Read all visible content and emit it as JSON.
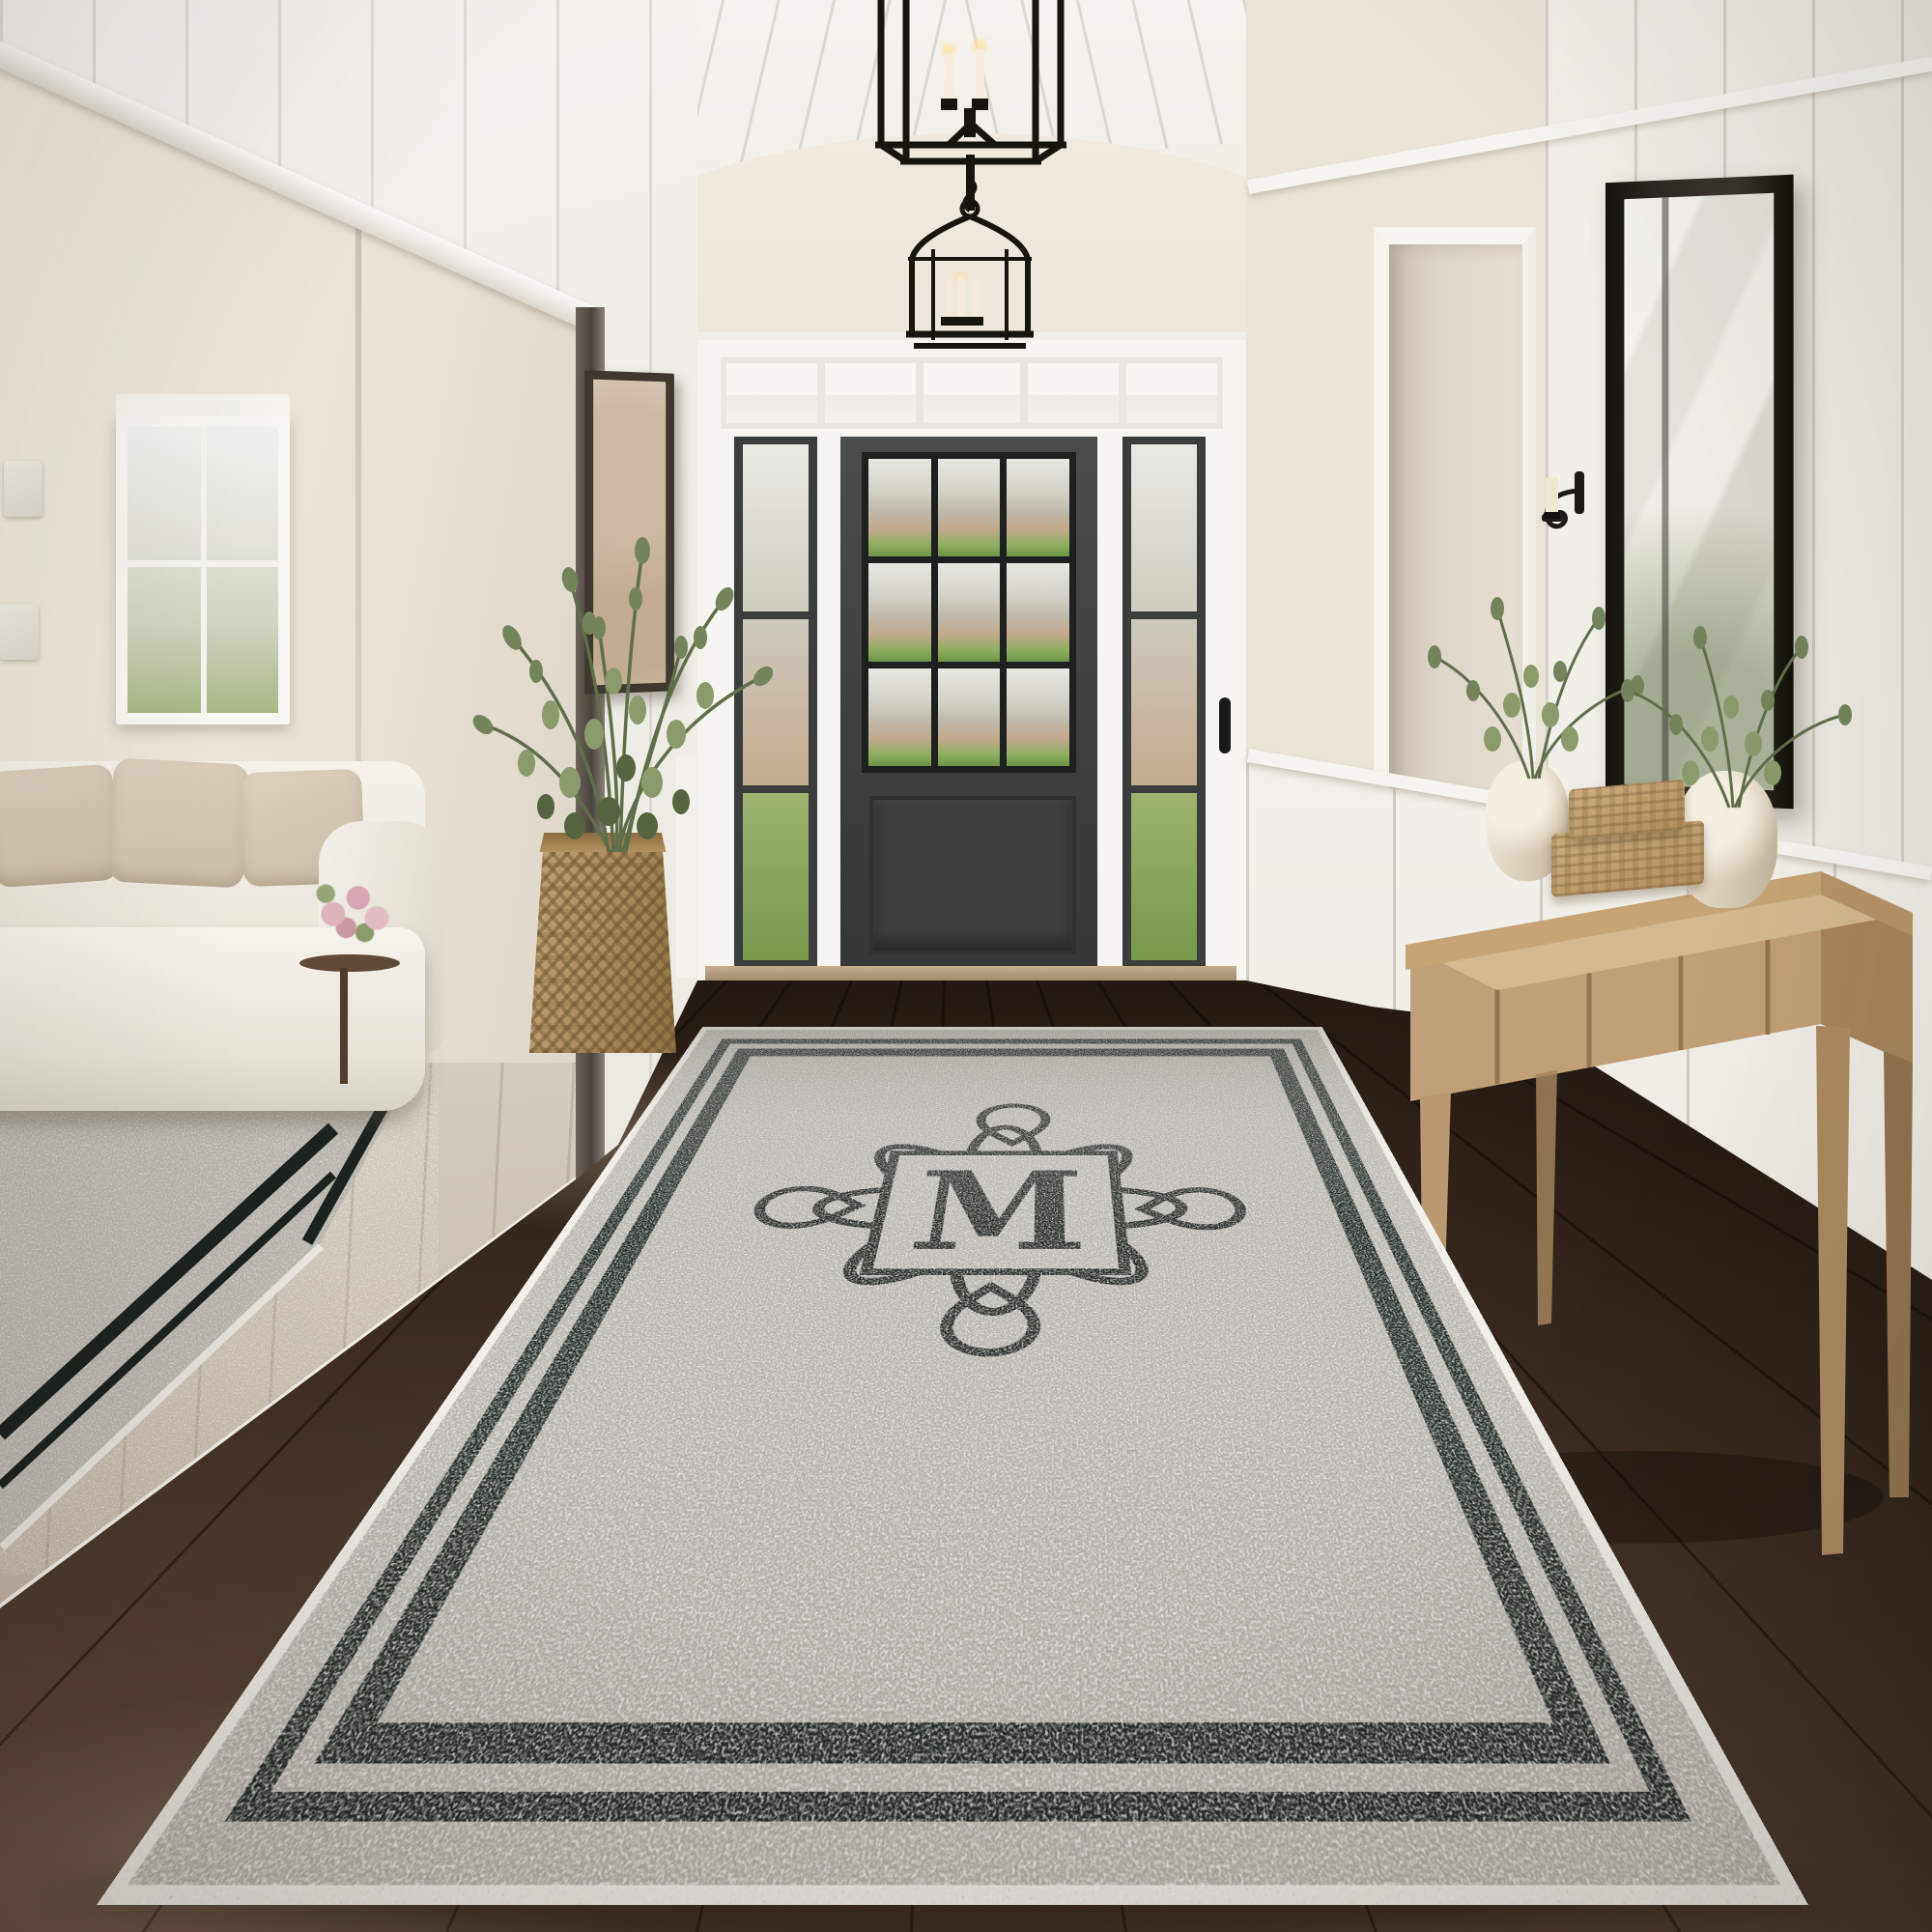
{
  "scene": {
    "monogram": "M",
    "palette": {
      "wall_cream": "#e8e2d7",
      "trim_white": "#f6f5f1",
      "panel_white": "#f1efe9",
      "door_charcoal": "#3f4241",
      "glass_mullion": "#1f2322",
      "floor_wood_dark": "#3a2b21",
      "floor_wood_light": "#c7bfb1",
      "rug_field_gray": "#b5b2ab",
      "rug_stripe_black": "#1b2220",
      "rug_binding": "#efeee8",
      "monogram_ink": "#20231f",
      "console_oak": "#c5a47c",
      "wicker_tan": "#b1925f",
      "greenery_green": "#6c7a52",
      "vase_cream": "#ece4d4",
      "sofa_ivory": "#f2efe8",
      "pillow_beige": "#d8cdb9",
      "grass_green": "#7fa055",
      "sky_haze": "#e9e8e3"
    }
  }
}
